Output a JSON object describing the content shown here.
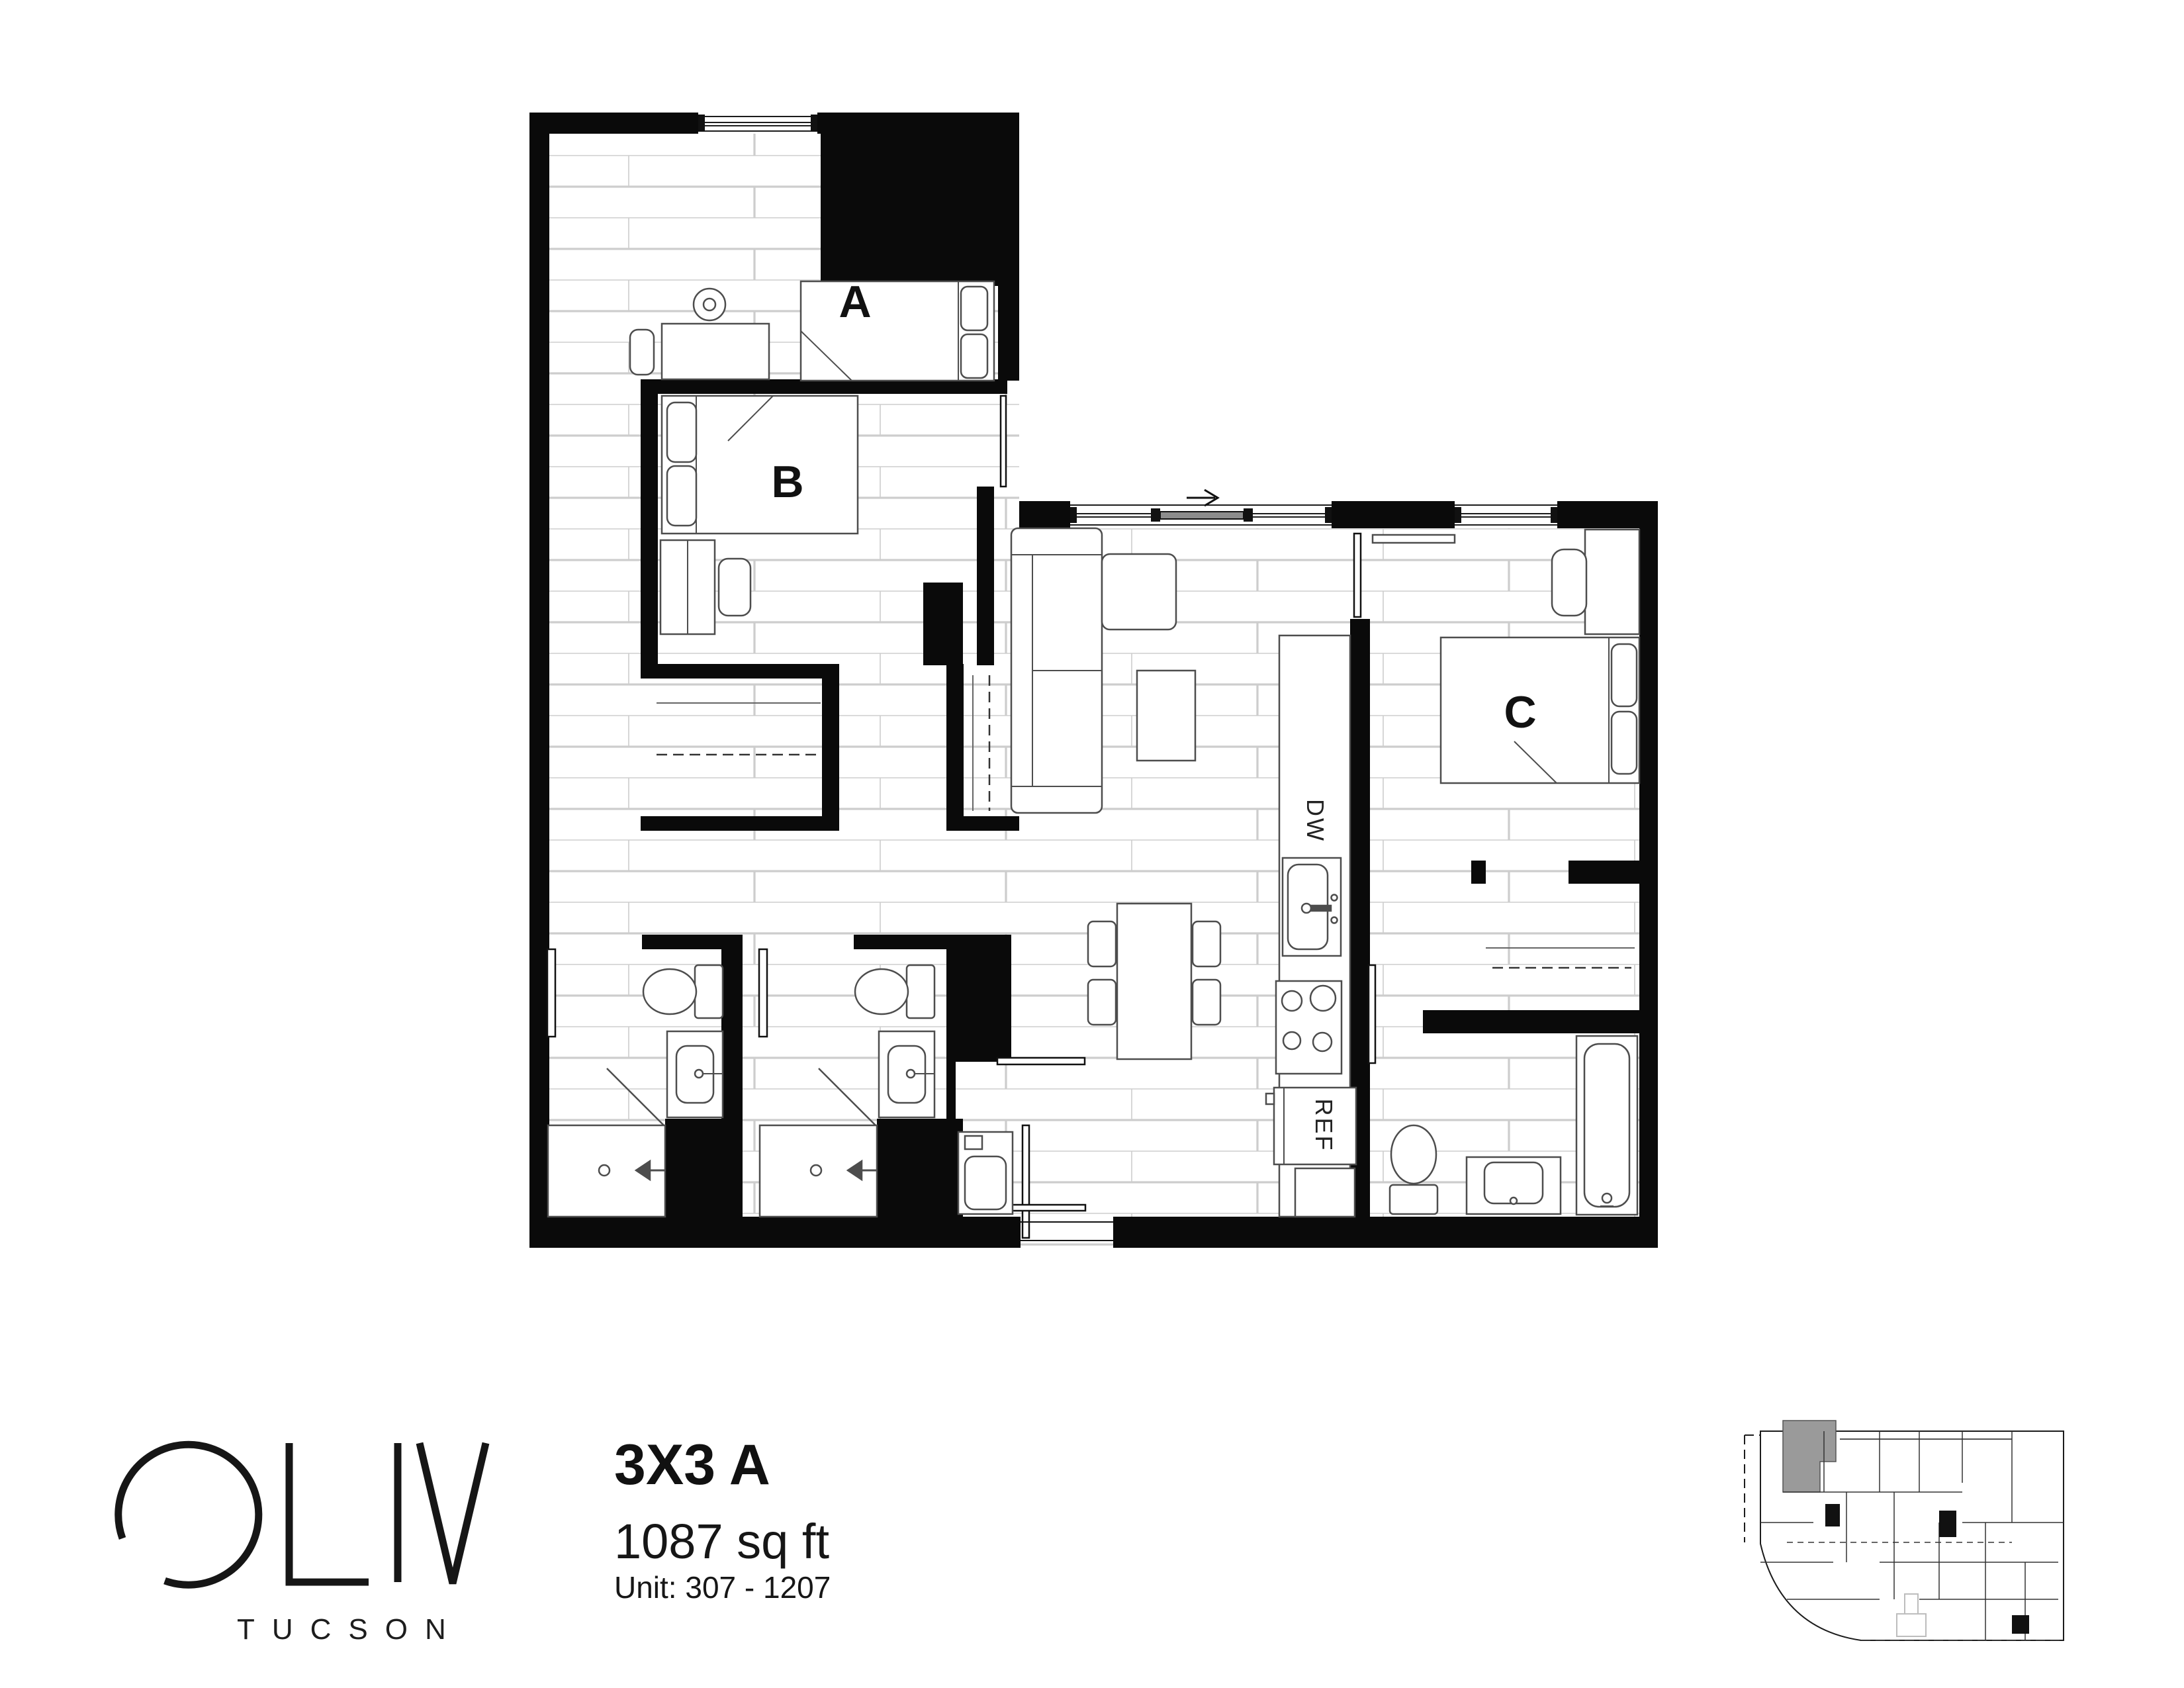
{
  "brand": {
    "name": "OLIV",
    "name_suffix": "LIV",
    "city": "TUCSON"
  },
  "title_block": {
    "plan_name": "3X3 A",
    "area": "1087 sq ft",
    "unit_range": "Unit: 307 - 1207"
  },
  "floor_plan": {
    "room_labels": {
      "a": "A",
      "b": "B",
      "c": "C"
    },
    "appliance_labels": {
      "dishwasher": "DW",
      "refrigerator": "REF"
    }
  },
  "colors": {
    "wall": "#0a0a0a",
    "floor_line": "#cdcdcd",
    "fixture_line": "#4d4d4d",
    "keyplan_unit_highlight": "#9a9a9a",
    "page_bg": "#ffffff"
  }
}
